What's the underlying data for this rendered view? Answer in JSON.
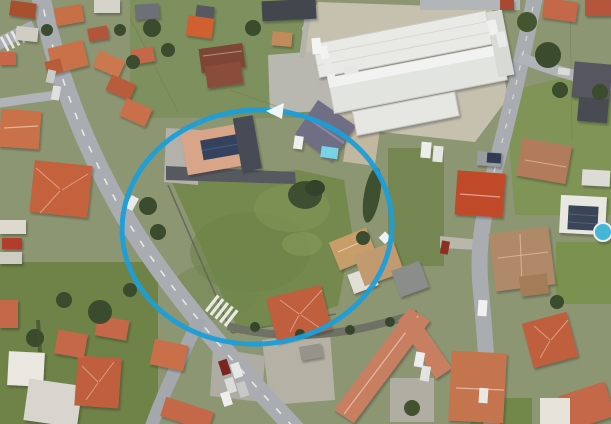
{
  "meta": {
    "view": "satellite-aerial-photo",
    "width_px": 611,
    "height_px": 424,
    "visible_text": "none"
  },
  "annotation": {
    "shape": "ellipse-with-arrowhead",
    "purpose": "highlighted-property-area",
    "color": "#1b9ed9",
    "arrowhead_color": "#eef6fb",
    "center_x": 257,
    "center_y": 227,
    "radius_x": 135,
    "radius_y": 117,
    "stroke_width": 5
  },
  "palette": {
    "grass_base": "#8d9672",
    "field_green": "#75894e",
    "lawn_bright": "#7e9454",
    "road_gray": "#a9adb1",
    "road_dark": "#6e7265",
    "marking_white": "#f2f3f1",
    "roof_terracotta": "#c4684a",
    "roof_red": "#b2553a",
    "roof_brown": "#7e4636",
    "roof_slate": "#6f6e85",
    "roof_dark_gray": "#55575e",
    "roof_pale_salmon": "#d9a588",
    "roof_apartment": "#c87e60",
    "warehouse_white": "#e9eae6",
    "concrete": "#c6c0ae",
    "tree_green": "#3a4b2e",
    "pool_cyan": "#79d3e8",
    "solar_panel": "#35425f"
  },
  "features": [
    {
      "id": "circled-lot",
      "label": "green vacant lot highlighted by blue ellipse annotation"
    },
    {
      "id": "warehouse",
      "label": "large white industrial building, top center"
    },
    {
      "id": "residential-area",
      "label": "houses with terracotta tile roofs"
    },
    {
      "id": "main-road",
      "label": "street running diagonally from top-left to bottom-center"
    },
    {
      "id": "east-road",
      "label": "curving street on right side"
    },
    {
      "id": "solar-roof-house",
      "label": "house with rooftop solar panels inside circle"
    },
    {
      "id": "slate-roof-house",
      "label": "dark slate-roof house with small pool inside circle"
    },
    {
      "id": "apartment-block",
      "label": "L-shaped apartment building, bottom-right"
    },
    {
      "id": "parking-cars",
      "label": "parked cars near bottom junction"
    }
  ]
}
